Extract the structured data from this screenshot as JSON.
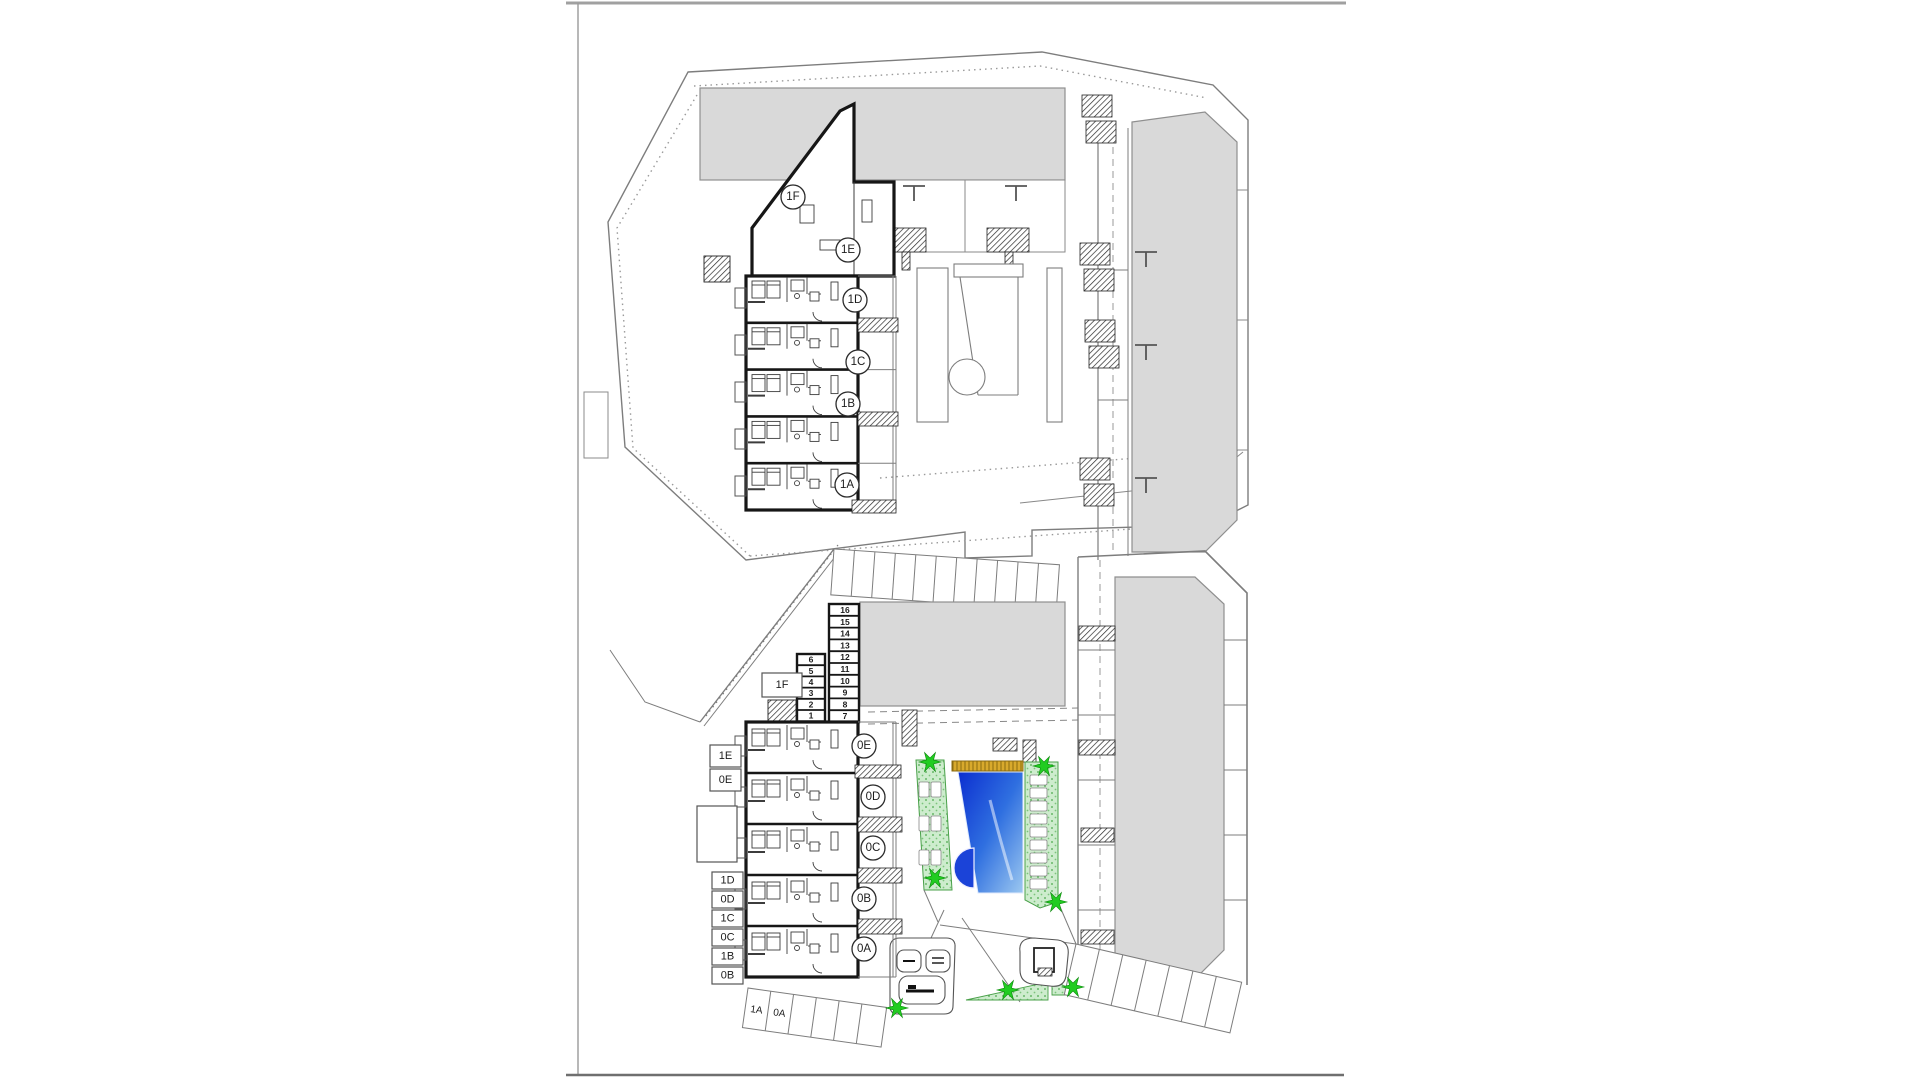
{
  "sheet": {
    "description": "Residential development floor plans, upper floor and ground floor with pool",
    "border_color": "#9a9a9a"
  },
  "colors": {
    "wall_black": "#161616",
    "line_gray": "#787878",
    "building_gray": "#d9d9d9",
    "pool_deep": "#0b2ed0",
    "pool_mid": "#2f6fe0",
    "pool_light": "#9cc8f0",
    "pool_step": "#1b43d8",
    "gold_strip": "#d8a92c",
    "green_area": "#cdeccd",
    "green_dot": "#4aa84a",
    "star_green": "#21cc21"
  },
  "upper_plan": {
    "circles": [
      {
        "label": "1F"
      },
      {
        "label": "1E"
      },
      {
        "label": "1D"
      },
      {
        "label": "1C"
      },
      {
        "label": "1B"
      },
      {
        "label": "1A"
      }
    ]
  },
  "ground_plan": {
    "circles": [
      {
        "label": "0E"
      },
      {
        "label": "0D"
      },
      {
        "label": "0C"
      },
      {
        "label": "0B"
      },
      {
        "label": "0A"
      }
    ],
    "boxes": [
      {
        "label": "1F"
      },
      {
        "label": "1E"
      },
      {
        "label": "0E"
      },
      {
        "label": "1D"
      },
      {
        "label": "0D"
      },
      {
        "label": "1C"
      },
      {
        "label": "0C"
      },
      {
        "label": "1B"
      },
      {
        "label": "0B"
      }
    ],
    "parking_stalls": [
      {
        "label": "1A"
      },
      {
        "label": "0A"
      }
    ],
    "storage_right": [
      "16",
      "15",
      "14",
      "13",
      "12",
      "11",
      "10",
      "9",
      "8",
      "7"
    ],
    "storage_left": [
      "6",
      "5",
      "4",
      "3",
      "2",
      "1"
    ]
  }
}
